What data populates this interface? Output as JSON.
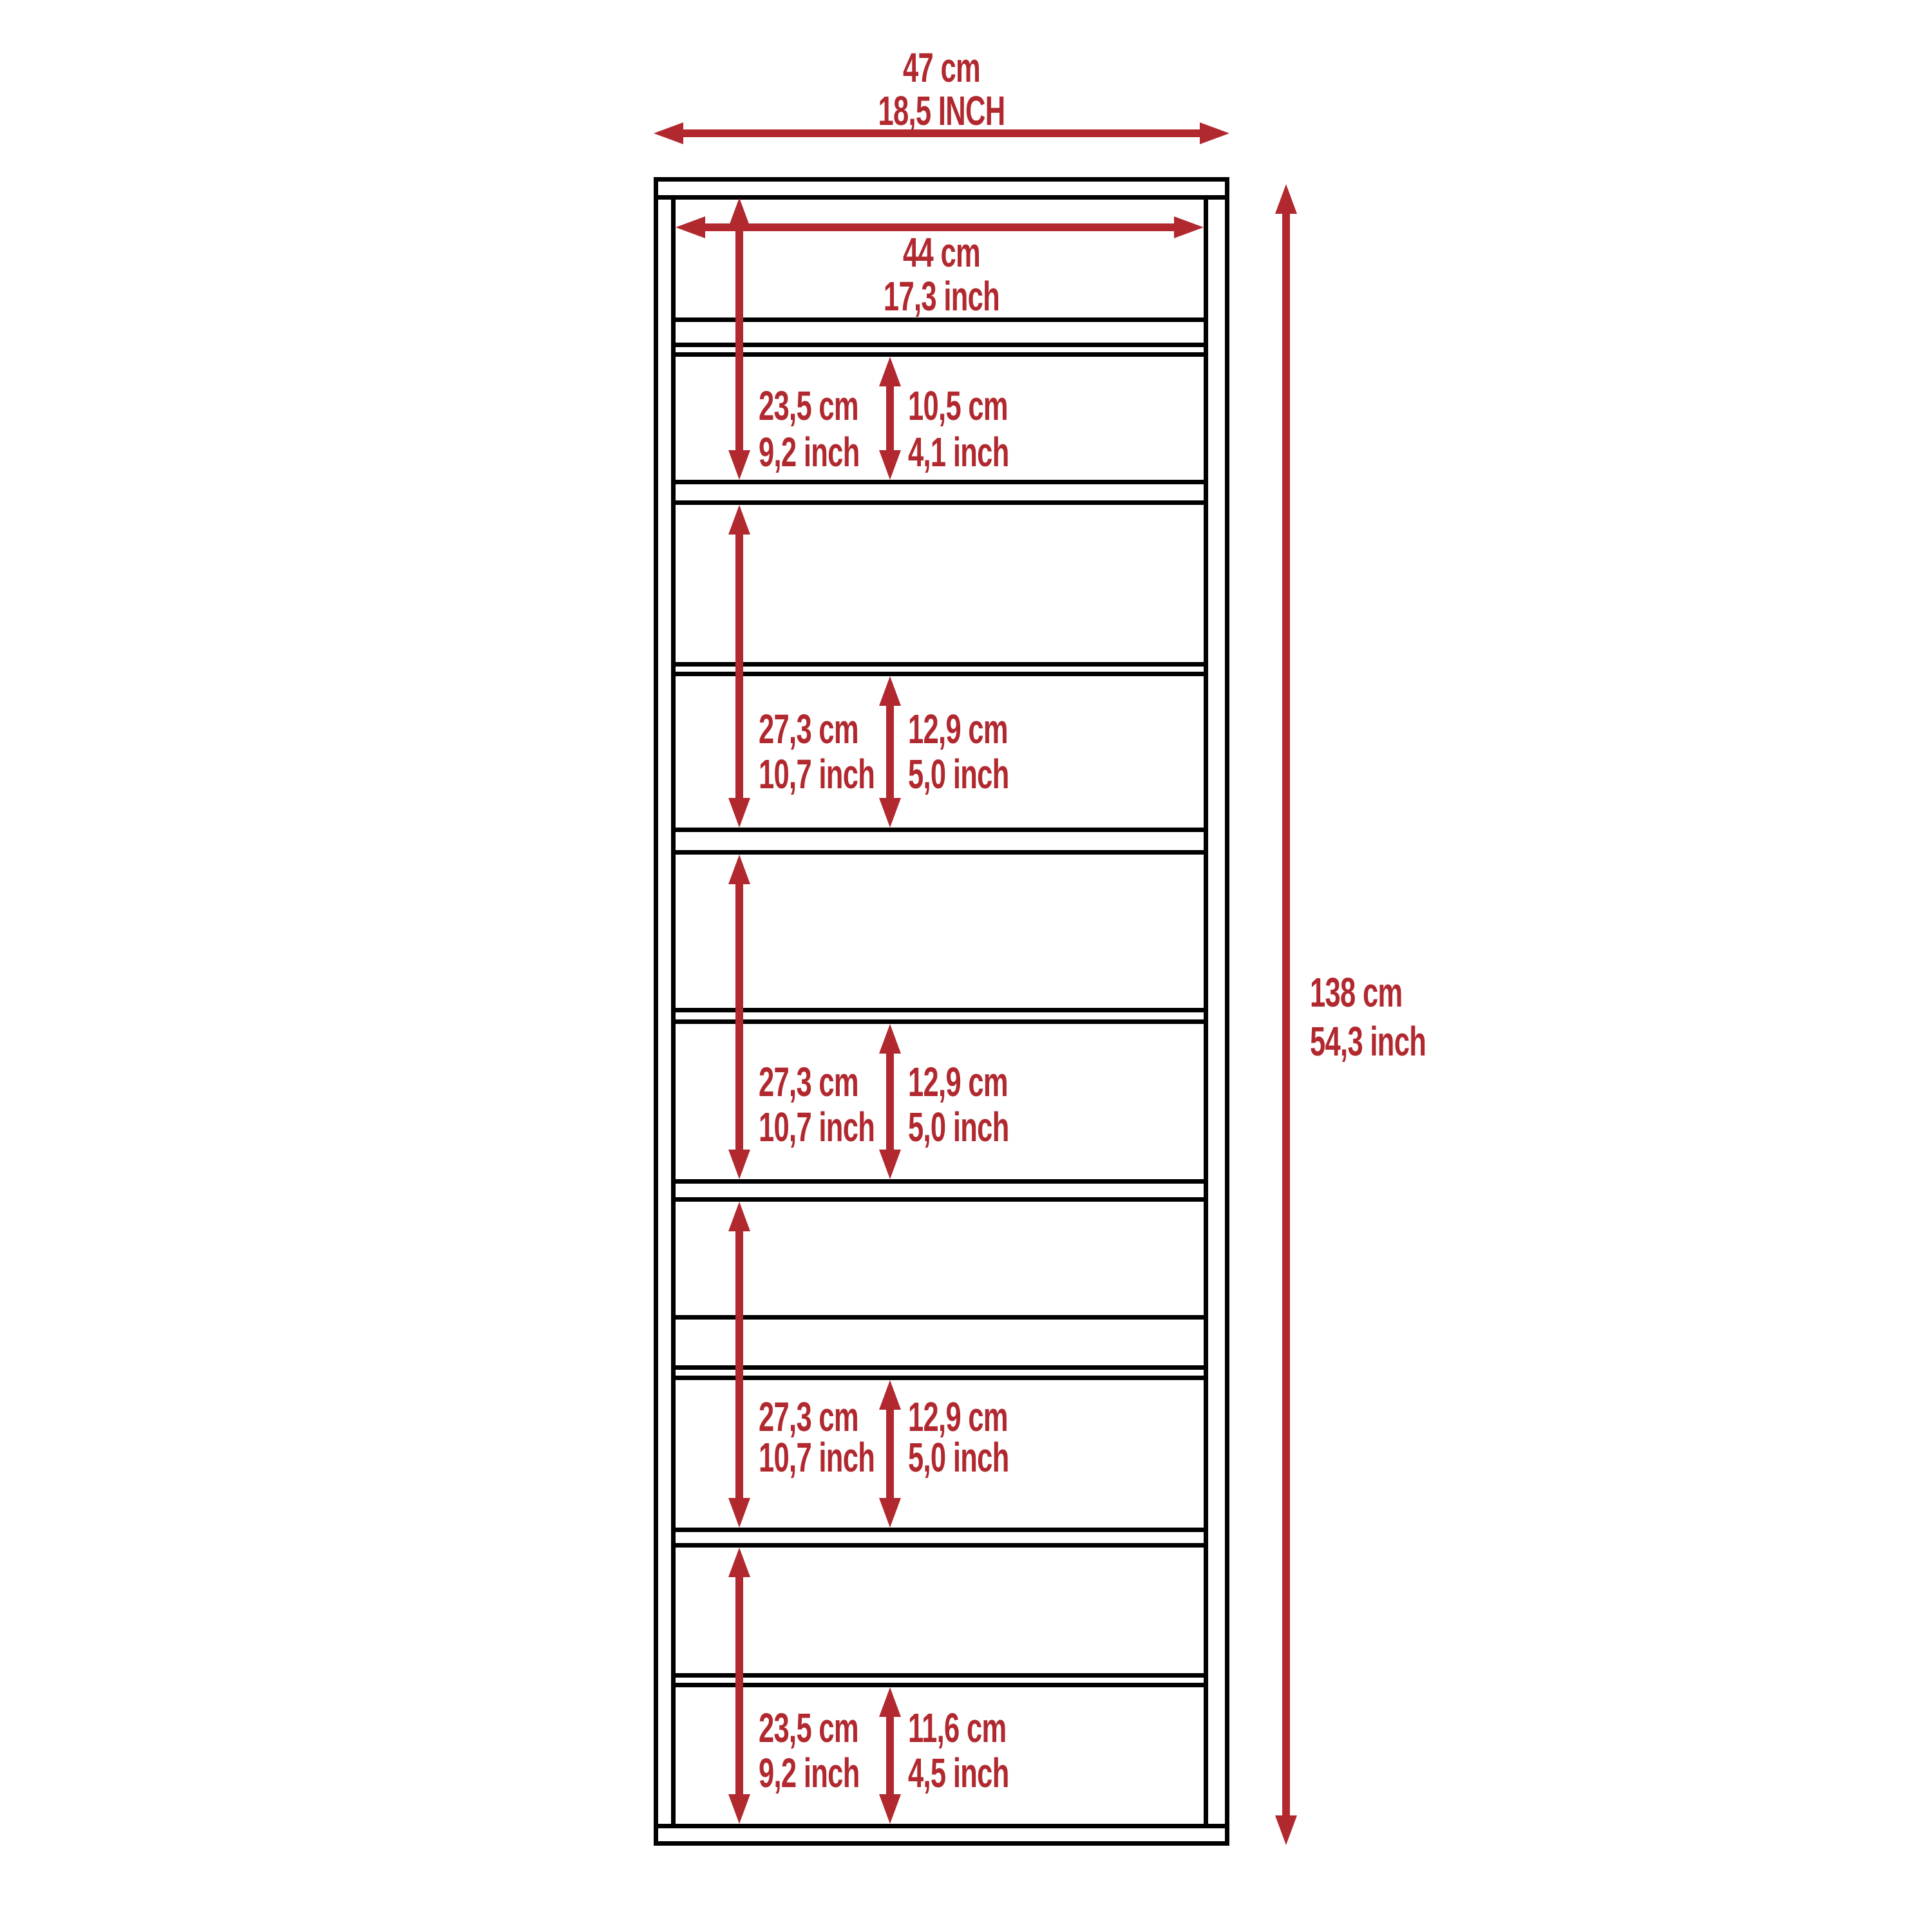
{
  "dimensions": {
    "overall_width": {
      "cm": "47 cm",
      "inch": "18,5 INCH"
    },
    "inner_width": {
      "cm": "44 cm",
      "inch": "17,3 inch"
    },
    "overall_height": {
      "cm": "138 cm",
      "inch": "54,3 inch"
    }
  },
  "sections": [
    {
      "height_cm": "23,5 cm",
      "height_inch": "9,2 inch",
      "opening_cm": "10,5 cm",
      "opening_inch": "4,1 inch"
    },
    {
      "height_cm": "27,3 cm",
      "height_inch": "10,7 inch",
      "opening_cm": "12,9 cm",
      "opening_inch": "5,0 inch"
    },
    {
      "height_cm": "27,3 cm",
      "height_inch": "10,7 inch",
      "opening_cm": "12,9 cm",
      "opening_inch": "5,0 inch"
    },
    {
      "height_cm": "27,3 cm",
      "height_inch": "10,7 inch",
      "opening_cm": "12,9 cm",
      "opening_inch": "5,0 inch"
    },
    {
      "height_cm": "23,5 cm",
      "height_inch": "9,2 inch",
      "opening_cm": "11,6 cm",
      "opening_inch": "4,5 inch"
    }
  ],
  "colors": {
    "dimension_red": "#B1282F",
    "outline_black": "#000000",
    "background": "#FFFFFF"
  }
}
